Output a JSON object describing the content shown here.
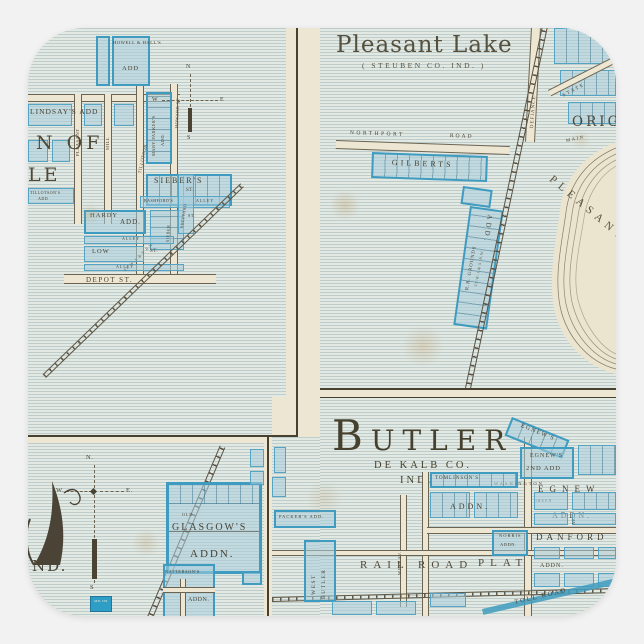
{
  "product": {
    "background_color": "#f2f2f3",
    "sticker_shape": "rounded-square"
  },
  "map": {
    "paper_color": "#ece6d3",
    "plat_blue": "#3f9cc0",
    "p1": {
      "howell": "HOWELL & HALL'S",
      "howell_add": "ADD",
      "lindsays": "LINDSAY'S ADD",
      "big1": "N OF",
      "big2": "LE",
      "mary": "MARY PARKER'S",
      "mary_add": "ADD.",
      "howard": "HOWARD ST",
      "pleasant": "PLEASANT",
      "mill": "MILL",
      "tillotson": "TILLOTSON",
      "tillotsons_small": "TILLOTSON'S",
      "tillotsons_add": "ADD",
      "siebers": "SIEBER'S",
      "siebers_st": "ST.",
      "bashfords": "BASHFORD'S",
      "alley_a": "ALLEY",
      "sheppard": "SHEPPARD",
      "sheppard_st": "ST.",
      "hardy": "HARDY",
      "hardy_add": "ADD.",
      "sieber_v": "SIEBER",
      "alley_b": "ALLEY",
      "low": "LOW",
      "low_st": "ST.",
      "alley_c": "ALLEY",
      "depot": "DEPOT ST.",
      "rr": "FT. W. J. & S. R.W.",
      "compass": {
        "n": "N",
        "w": "W",
        "e": "E",
        "s": "S"
      }
    },
    "p2": {
      "title": "Pleasant Lake",
      "subtitle": "( STEUBEN CO. IND. )",
      "northport": "NORTHPORT",
      "road": "ROAD",
      "gilberts": "GILBERTS",
      "add_stack": "ADD.",
      "rr_grounds": "R.R. GROUNDS",
      "rr_name": "FT.W. J.& S. R.W.",
      "defiance": "DEFIANCE",
      "state": "STATE",
      "orig": "ORIG.",
      "main": "MAIN",
      "lake": "PLEASANT"
    },
    "p3": {
      "nd": "ND.",
      "old": "OLD",
      "glasgows": "GLASGOW'S",
      "glasgows_add": "ADDN.",
      "battersons": "BATTERSON'S",
      "battersons_add": "ADDN.",
      "church": "M.E. CH.",
      "compass": {
        "n": "N.",
        "w": "W.",
        "e": "E.",
        "s": "S"
      }
    },
    "p4": {
      "title": "BUTLER",
      "county": "DE KALB CO.",
      "state": "IND.",
      "egnew_diag": "EGNEW'S",
      "egnews": "EGNEW'S",
      "second_add": "2ND ADD",
      "washington": "WASHINGTON",
      "egnew": "EGNEW",
      "addn_a": "ADDN.",
      "tomlinsons": "TOMLINSON'S",
      "addn_b": "ADDN.",
      "green": "GREEN",
      "norris": "NORRIS",
      "norris_add": "ADDN.",
      "danford": "DANFORD",
      "danford_add": "ADDN.",
      "rail_road": "RAIL ROAD",
      "plat": "PLAT",
      "packers": "PACKER'S ADD.",
      "west": "WEST",
      "butler_v": "BUTLER",
      "west_av": "WEST AV.",
      "av": "AV.",
      "toll_road": "TOLL ROAD"
    }
  }
}
